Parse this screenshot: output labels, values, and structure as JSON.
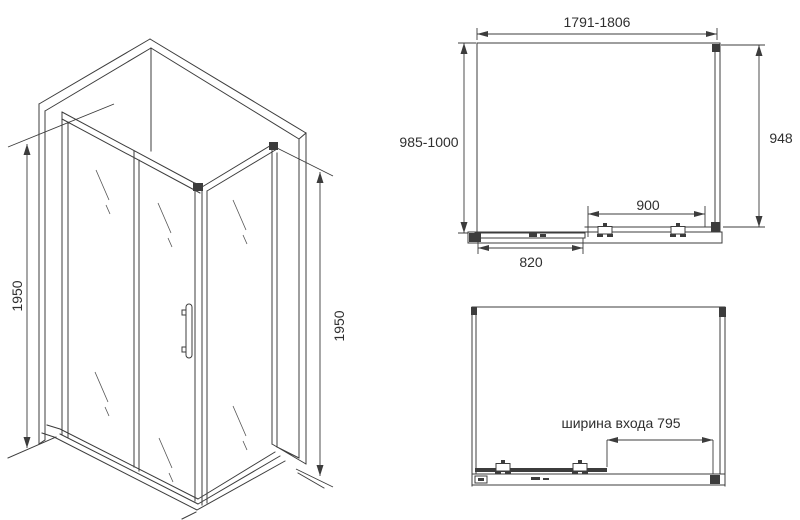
{
  "drawing": {
    "kind": "shower-enclosure-technical-drawing",
    "background": "#ffffff",
    "line_color": "#3c3c3c",
    "iso_view": {
      "left_height": "1950",
      "right_height": "1950"
    },
    "plan_view_closed": {
      "overall_width": "1791-1806",
      "overall_depth": "985-1000",
      "side_panel_depth": "948",
      "door_section_width": "900",
      "fixed_panel_width": "820"
    },
    "plan_view_open": {
      "entrance_width": "ширина входа 795"
    }
  }
}
